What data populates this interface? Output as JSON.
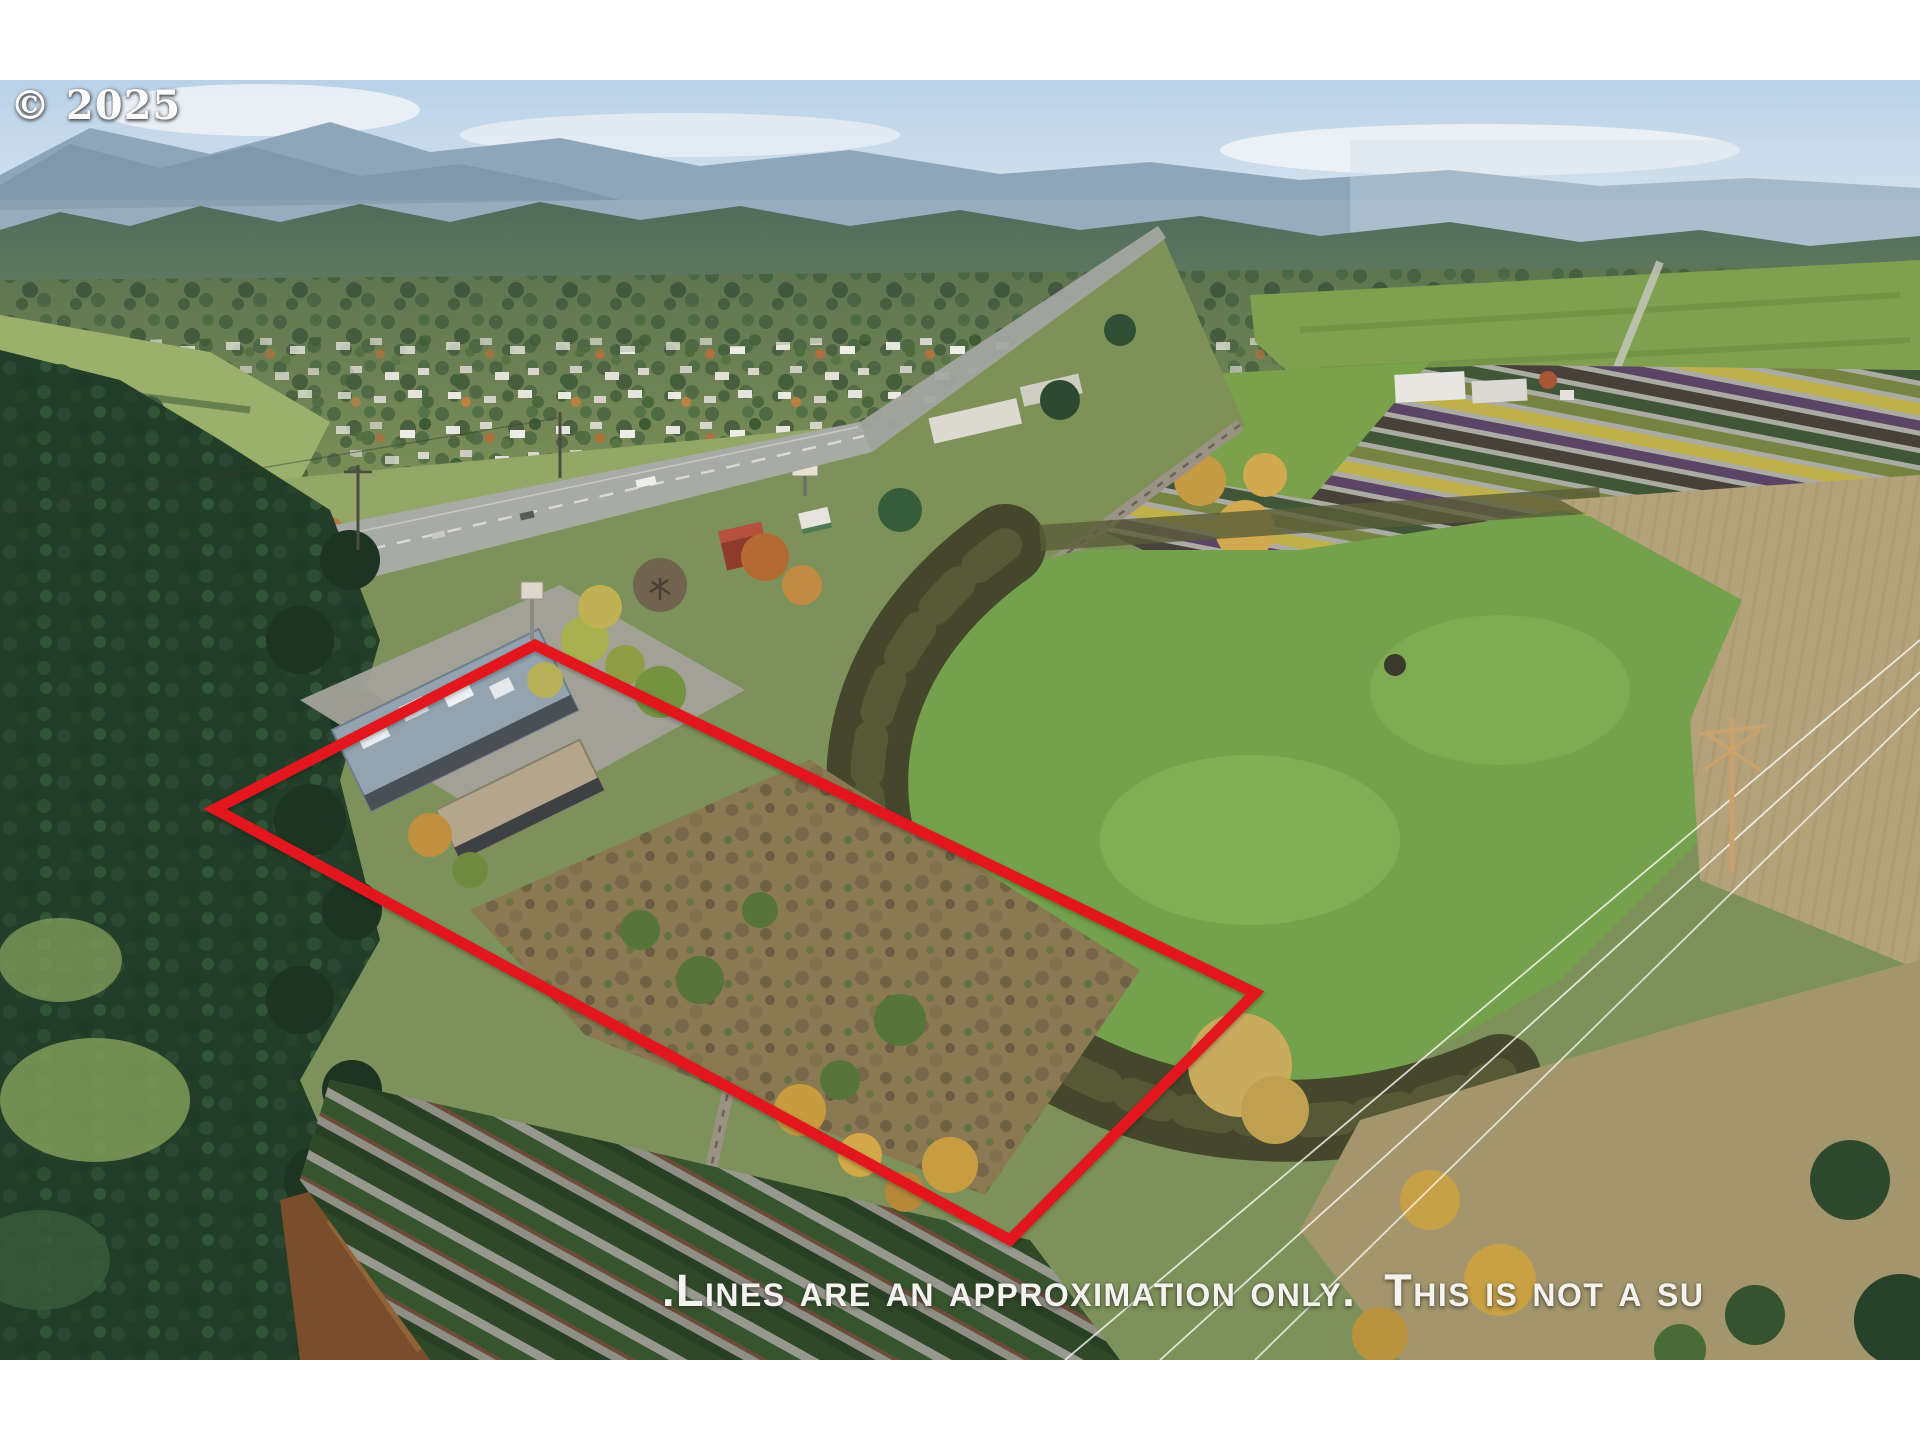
{
  "photo": {
    "kind": "aerial-drone-photo-of-listed-property",
    "watermark": "© 2025",
    "disclaimer": ".Lines are an approximation only.  This is not a su",
    "boundary_color": "#e2191b",
    "letterbox_color": "#ffffff"
  }
}
